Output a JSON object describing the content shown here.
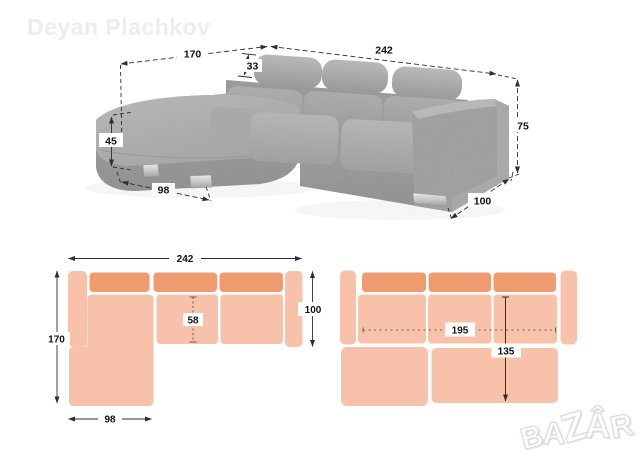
{
  "watermark": {
    "text": "Deyan Plachkov"
  },
  "brand_logo": {
    "letters": [
      "B",
      "A",
      "Z",
      "Â",
      "R"
    ]
  },
  "photo_dims": {
    "total_width": "242",
    "chaise_depth": "170",
    "headrest_height": "33",
    "total_height": "75",
    "seat_height": "45",
    "chaise_width": "98",
    "arm_depth": "100"
  },
  "plan_sofa": {
    "total_width": "242",
    "total_depth": "170",
    "seat_depth": "58",
    "body_depth": "100",
    "chaise_width": "98"
  },
  "plan_bed": {
    "bed_width": "195",
    "bed_depth": "135"
  },
  "colors": {
    "plan_base": "#F7C2A9",
    "plan_cushion": "#EE9C6F",
    "dimension": "#2e2e2e",
    "fabric_gray": "#9b9b9b",
    "watermark_gray": "#ecedf1"
  }
}
